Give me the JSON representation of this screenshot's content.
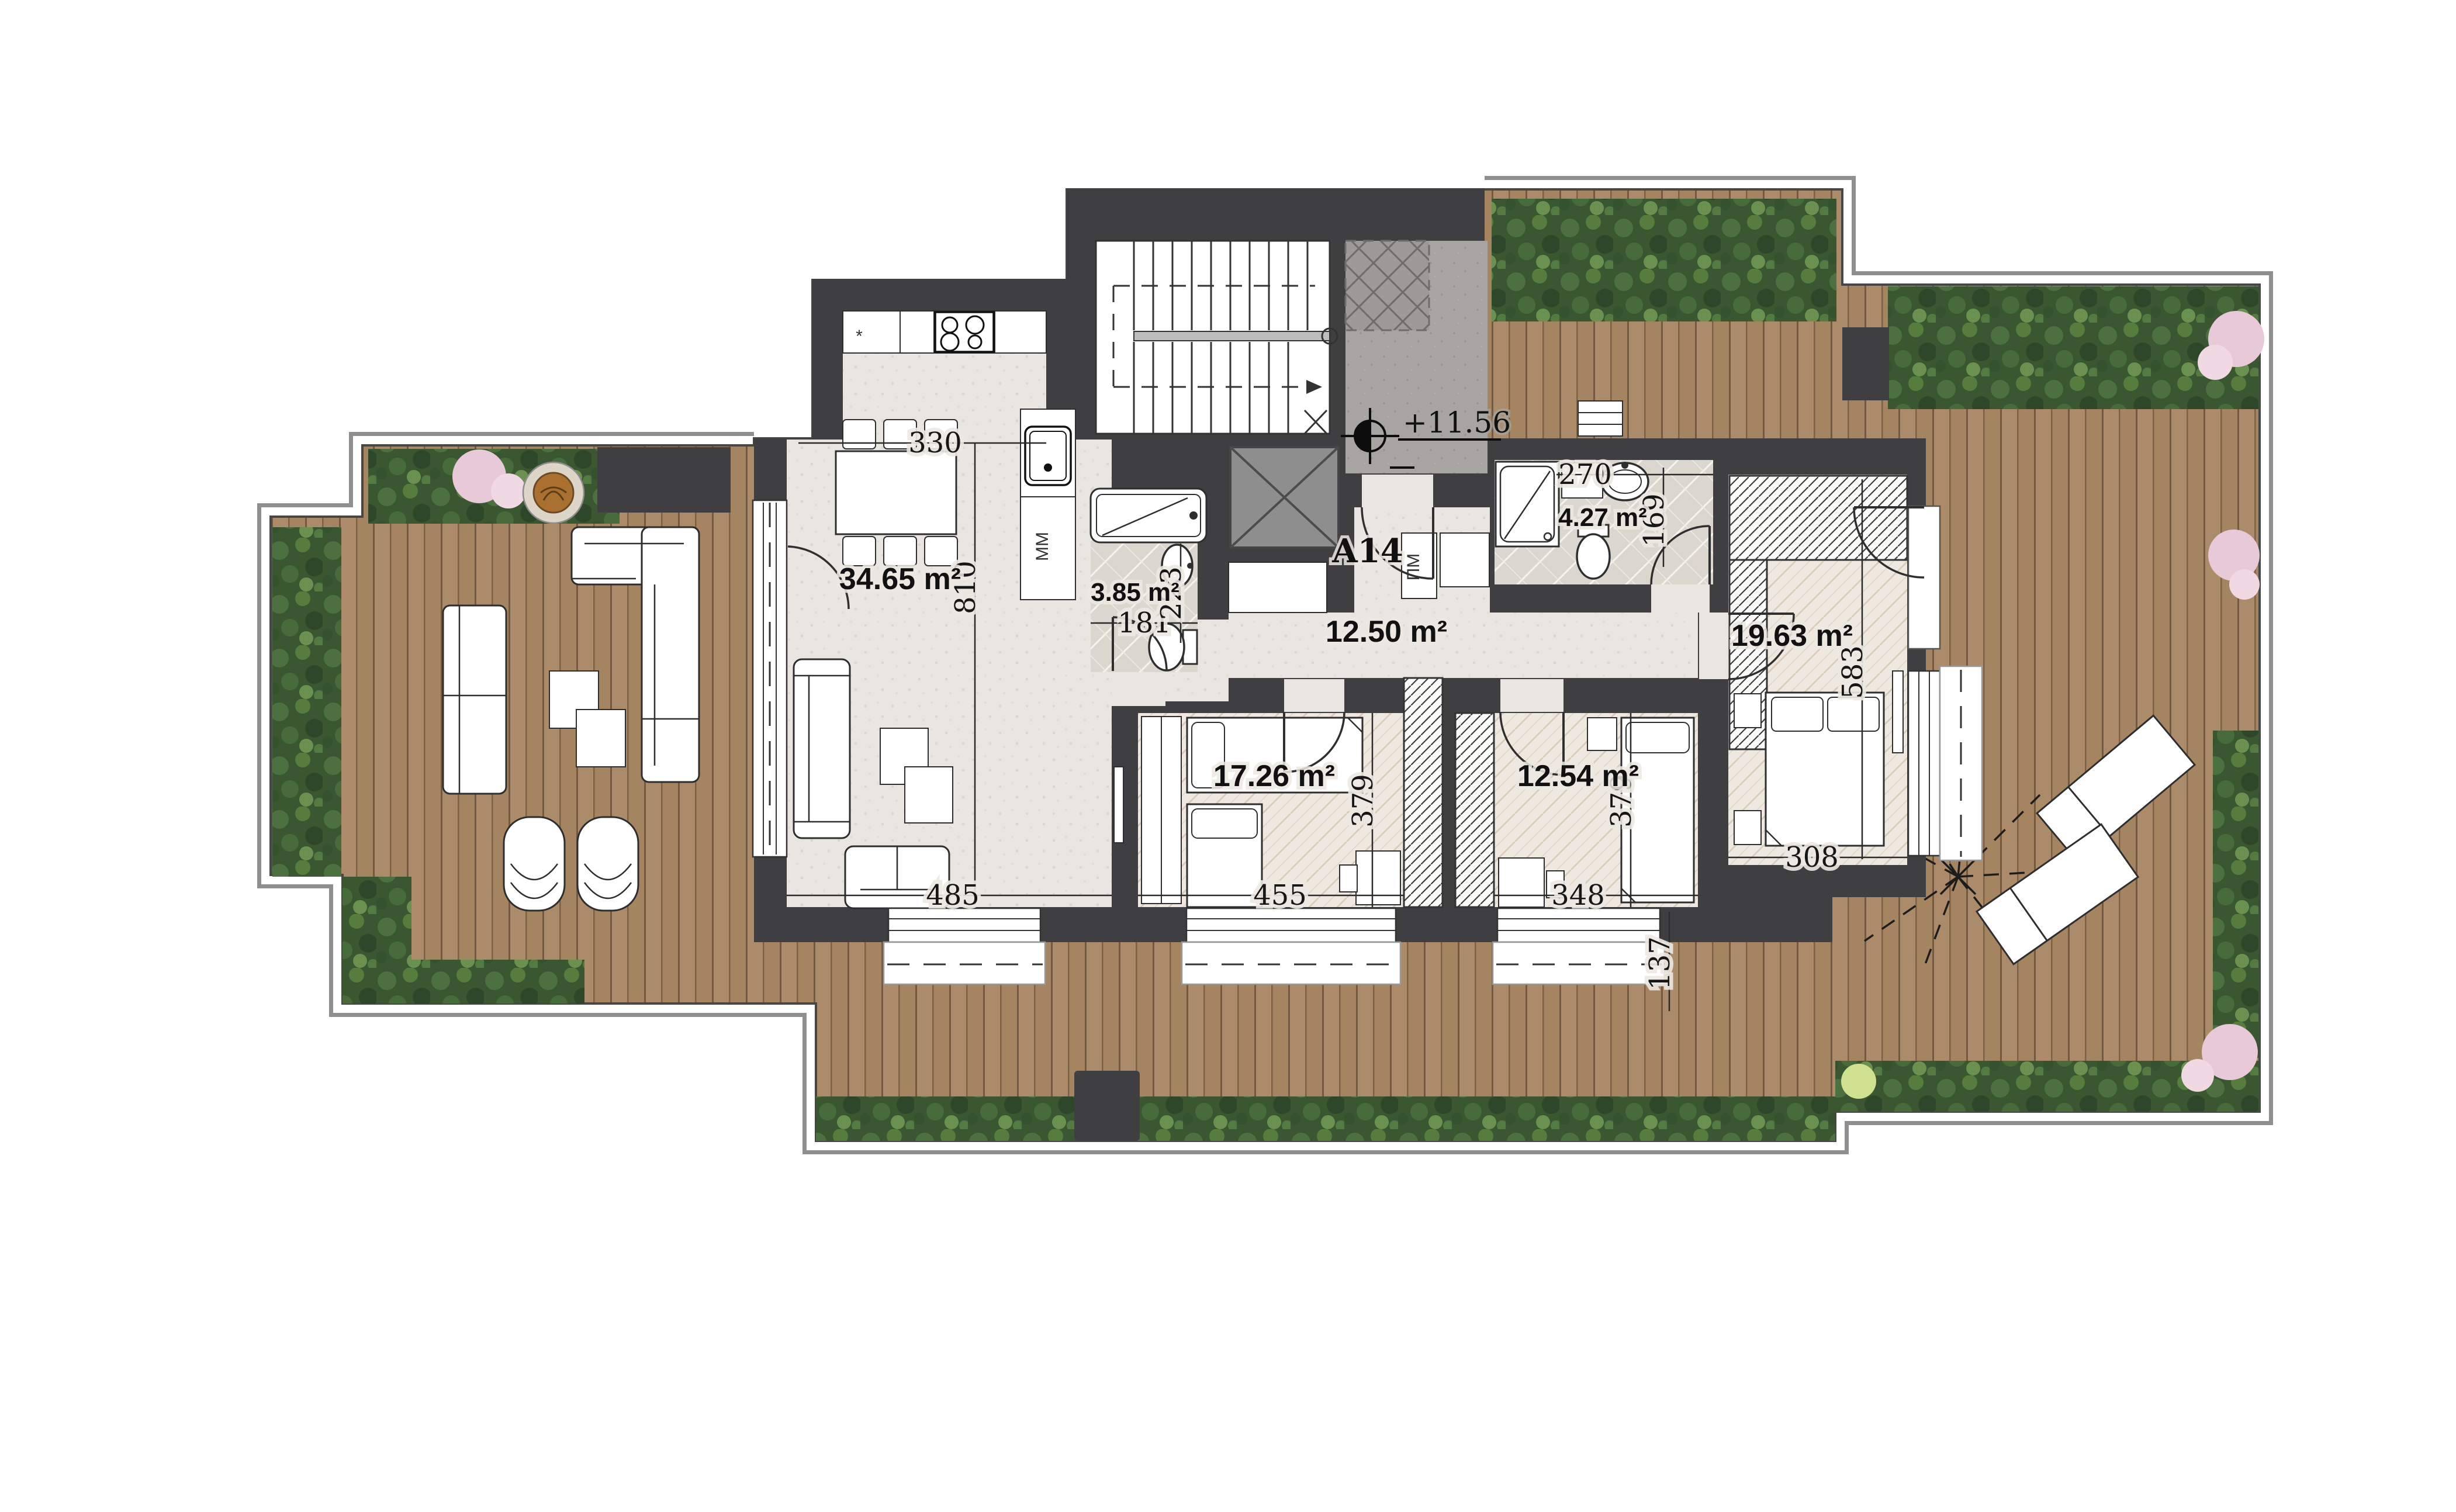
{
  "plan": {
    "apartment_label": "A14",
    "elevation_marker": "+11.56",
    "rooms": {
      "living": {
        "area": "34.65 m²"
      },
      "bath1": {
        "area": "3.85 m²"
      },
      "hall": {
        "area": "12.50 m²"
      },
      "bath2": {
        "area": "4.27 m²"
      },
      "master": {
        "area": "19.63 m²"
      },
      "bed1": {
        "area": "17.26 m²"
      },
      "bed2": {
        "area": "12.54 m²"
      }
    },
    "dimensions": {
      "kitchen_width": "330",
      "living_depth": "810",
      "living_width": "485",
      "bath1_width": "181",
      "bath1_depth": "223",
      "bath2_width": "270",
      "bath2_door": "169",
      "bed1_width": "455",
      "bed1_depth": "379",
      "bed2_width": "348",
      "bed2_depth": "379",
      "master_width": "308",
      "master_depth": "583",
      "window_offset": "137"
    },
    "appliances": {
      "dishwasher": "ММ",
      "washing_machine": "ПМ",
      "stove_mark": "*"
    },
    "colors": {
      "wall": "#3f3f42",
      "deck": "#ac8b6b",
      "deck_line": "#74593f",
      "interior_floor": "#e9e6e1",
      "lobby_floor": "#a7a5a2",
      "greenery": "#3a5731",
      "flowers": "#e8c9d8",
      "elevator": "#8e8e8e"
    }
  }
}
